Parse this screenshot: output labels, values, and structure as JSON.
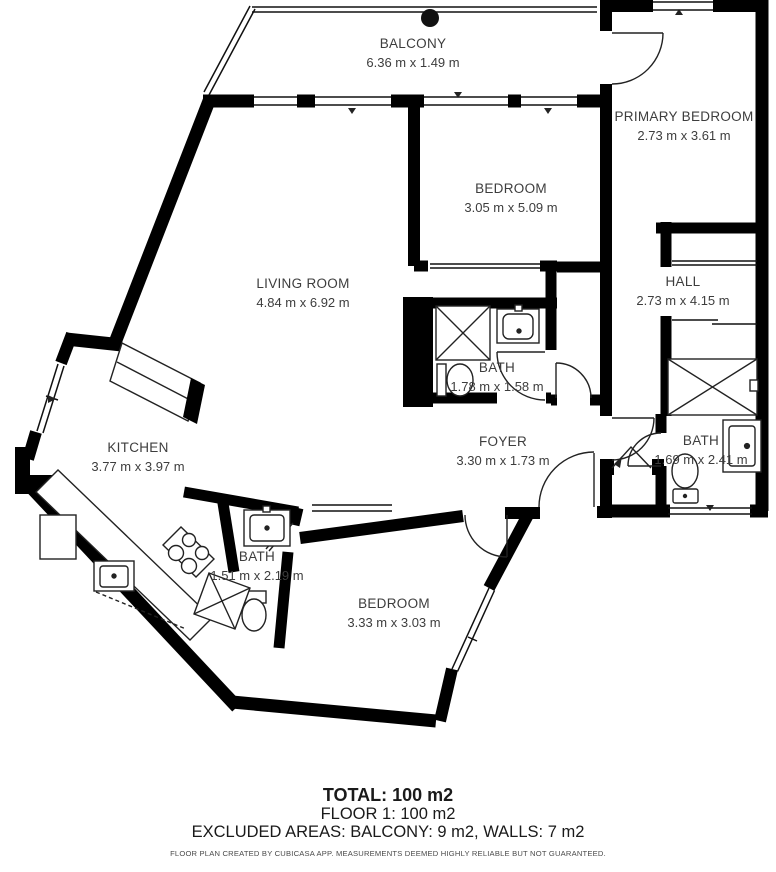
{
  "rooms": {
    "balcony": {
      "name": "BALCONY",
      "dims": "6.36 m x 1.49 m"
    },
    "primary_bedroom": {
      "name": "PRIMARY BEDROOM",
      "dims": "2.73 m x 3.61 m"
    },
    "bedroom_top": {
      "name": "BEDROOM",
      "dims": "3.05 m x 5.09 m"
    },
    "living_room": {
      "name": "LIVING ROOM",
      "dims": "4.84 m x 6.92 m"
    },
    "hall": {
      "name": "HALL",
      "dims": "2.73 m x 4.15 m"
    },
    "bath_center": {
      "name": "BATH",
      "dims": "1.78 m x 1.58 m"
    },
    "foyer": {
      "name": "FOYER",
      "dims": "3.30 m x 1.73 m"
    },
    "bath_right": {
      "name": "BATH",
      "dims": "1.69 m x 2.41 m"
    },
    "kitchen": {
      "name": "KITCHEN",
      "dims": "3.77 m x 3.97 m"
    },
    "bath_small": {
      "name": "BATH",
      "dims": "1.51 m x 2.19 m"
    },
    "bedroom_bottom": {
      "name": "BEDROOM",
      "dims": "3.33 m x 3.03 m"
    }
  },
  "summary": {
    "total": "TOTAL: 100 m2",
    "floor": "FLOOR 1: 100 m2",
    "excluded": "EXCLUDED AREAS: BALCONY: 9 m2, WALLS: 7 m2",
    "disclaimer": "FLOOR PLAN CREATED BY CUBICASA APP. MEASUREMENTS DEEMED HIGHLY RELIABLE BUT NOT GUARANTEED."
  },
  "colors": {
    "wall": "#000000",
    "label_text": "#3d3d3d",
    "summary_text": "#1a1a1a",
    "disclaimer_text": "#4a4a4a",
    "fixture_line": "#222222",
    "background": "#ffffff"
  }
}
